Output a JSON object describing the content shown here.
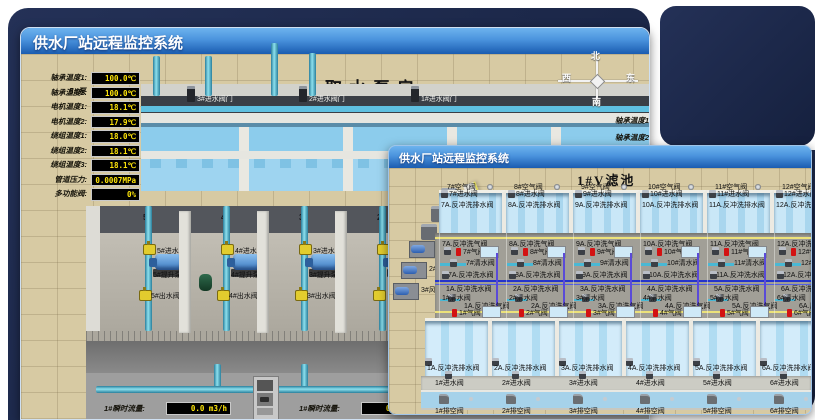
{
  "colors": {
    "backdrop_navy": "#1b2a50",
    "titlebar_top": "#6db3ee",
    "titlebar_bottom": "#1a5cb0",
    "ground_tan": "#d7caa3",
    "water_blue": "#a9d6ee",
    "pipe_cyan": "#5fc6da",
    "valve_yellow": "#e2cc2e",
    "value_yellow": "#ffe60a",
    "alarm_red": "#d31212"
  },
  "window1": {
    "title": "供水厂站远程监控系统",
    "scene_title": "取水泵房",
    "pump_label": "5#泵",
    "readings": [
      {
        "label": "轴承温度1:",
        "value": "100.0℃"
      },
      {
        "label": "轴承温度2:",
        "value": "100.0℃"
      },
      {
        "label": "电机温度1:",
        "value": "18.1℃"
      },
      {
        "label": "电机温度2:",
        "value": "17.9℃"
      },
      {
        "label": "绕组温度1:",
        "value": "18.0℃"
      },
      {
        "label": "绕组温度2:",
        "value": "18.1℃"
      },
      {
        "label": "绕组温度3:",
        "value": "18.1℃"
      },
      {
        "label": "管道压力:",
        "value": "0.0007MPa"
      },
      {
        "label": "多功能阀:",
        "value": "0%"
      }
    ],
    "compass": {
      "north": "北",
      "west": "西",
      "south": "南",
      "east": "东"
    },
    "side_labels": [
      {
        "label": "轴承温度1"
      },
      {
        "label": "轴承温度2"
      }
    ],
    "intake_valves": [
      {
        "label": "3#进水阀门"
      },
      {
        "label": "2#进水阀门"
      },
      {
        "label": "1#进水阀门"
      }
    ],
    "pump_bays": [
      {
        "bay": "5#",
        "inlet": "5#进水阀",
        "pump": "5#提升泵",
        "outlet": "5#出水阀"
      },
      {
        "bay": "4#",
        "inlet": "4#进水阀",
        "pump": "4#提升泵",
        "outlet": "4#出水阀"
      },
      {
        "bay": "3#",
        "inlet": "3#进水阀",
        "pump": "3#提升泵",
        "outlet": "3#出水阀"
      },
      {
        "bay": "2#",
        "inlet": "",
        "pump": "",
        "outlet": ""
      }
    ],
    "current_readings": [
      {
        "label": "4#泵电流:",
        "value": "00.0 A"
      },
      {
        "label": "2#泵电流:",
        "value": ""
      }
    ],
    "flow_readings": [
      {
        "label": "1#瞬时流量:",
        "value": "0.0 m3/h"
      },
      {
        "label": "1#瞬时流量:",
        "value": "0.0 m3/h"
      }
    ]
  },
  "window2": {
    "title": "供水厂站远程监控系统",
    "scene_title": "1#V滤池",
    "pumps": [
      {
        "name": "1#水泵"
      },
      {
        "name": "2#水泵"
      },
      {
        "name": "3#水泵"
      }
    ],
    "blowers": [
      {
        "name": "1#风机"
      },
      {
        "name": "2#风机"
      },
      {
        "name": "3#风机"
      }
    ],
    "columns": [
      {
        "air_top": "7#空气阀",
        "inlet_top": "7#进水阀",
        "drain_top": "7A.反冲洗排水阀",
        "bw_air_top": "7A.反冲洗气阀",
        "gas_top": "7#气阀",
        "clean_top": "7#清水阀",
        "bw_water_top": "7A.反冲洗水阀",
        "bw_water_bot": "1A.反冲洗水阀",
        "clean_bot": "1#清水阀",
        "bw_air_bot": "1A.反冲洗气阀",
        "gas_bot": "1#气阀",
        "drain_bot": "1A.反冲洗排水阀",
        "inlet_bot": "1#进水阀",
        "empty_bot": "1#排空阀"
      },
      {
        "air_top": "8#空气阀",
        "inlet_top": "8#进水阀",
        "drain_top": "8A.反冲洗排水阀",
        "bw_air_top": "8A.反冲洗气阀",
        "gas_top": "8#气阀",
        "clean_top": "8#清水阀",
        "bw_water_top": "8A.反冲洗水阀",
        "bw_water_bot": "2A.反冲洗水阀",
        "clean_bot": "2#清水阀",
        "bw_air_bot": "2A.反冲洗气阀",
        "gas_bot": "2#气阀",
        "drain_bot": "2A.反冲洗排水阀",
        "inlet_bot": "2#进水阀",
        "empty_bot": "2#排空阀"
      },
      {
        "air_top": "9#空气阀",
        "inlet_top": "9#进水阀",
        "drain_top": "9A.反冲洗排水阀",
        "bw_air_top": "9A.反冲洗气阀",
        "gas_top": "9#气阀",
        "clean_top": "9#清水阀",
        "bw_water_top": "9A.反冲洗水阀",
        "bw_water_bot": "3A.反冲洗水阀",
        "clean_bot": "3#清水阀",
        "bw_air_bot": "3A.反冲洗气阀",
        "gas_bot": "3#气阀",
        "drain_bot": "3A.反冲洗排水阀",
        "inlet_bot": "3#进水阀",
        "empty_bot": "3#排空阀"
      },
      {
        "air_top": "10#空气阀",
        "inlet_top": "10#进水阀",
        "drain_top": "10A.反冲洗排水阀",
        "bw_air_top": "10A.反冲洗气阀",
        "gas_top": "10#气阀",
        "clean_top": "10#清水阀",
        "bw_water_top": "10A.反冲洗水阀",
        "bw_water_bot": "4A.反冲洗水阀",
        "clean_bot": "4#清水阀",
        "bw_air_bot": "4A.反冲洗气阀",
        "gas_bot": "4#气阀",
        "drain_bot": "4A.反冲洗排水阀",
        "inlet_bot": "4#进水阀",
        "empty_bot": "4#排空阀"
      },
      {
        "air_top": "11#空气阀",
        "inlet_top": "11#进水阀",
        "drain_top": "11A.反冲洗排水阀",
        "bw_air_top": "11A.反冲洗气阀",
        "gas_top": "11#气阀",
        "clean_top": "11#清水阀",
        "bw_water_top": "11A.反冲洗水阀",
        "bw_water_bot": "5A.反冲洗水阀",
        "clean_bot": "5#清水阀",
        "bw_air_bot": "5A.反冲洗气阀",
        "gas_bot": "5#气阀",
        "drain_bot": "5A.反冲洗排水阀",
        "inlet_bot": "5#进水阀",
        "empty_bot": "5#排空阀"
      },
      {
        "air_top": "12#空气阀",
        "inlet_top": "12#进水阀",
        "drain_top": "12A.反冲洗排水阀",
        "bw_air_top": "12A.反冲洗气阀",
        "gas_top": "12#气阀",
        "clean_top": "12#清水阀",
        "bw_water_top": "12A.反冲洗水阀",
        "bw_water_bot": "6A.反冲洗水阀",
        "clean_bot": "6#清水阀",
        "bw_air_bot": "6A.反冲洗气阀",
        "gas_bot": "6#气阀",
        "drain_bot": "6A.反冲洗排水阀",
        "inlet_bot": "6#进水阀",
        "empty_bot": "6#排空阀"
      }
    ]
  }
}
